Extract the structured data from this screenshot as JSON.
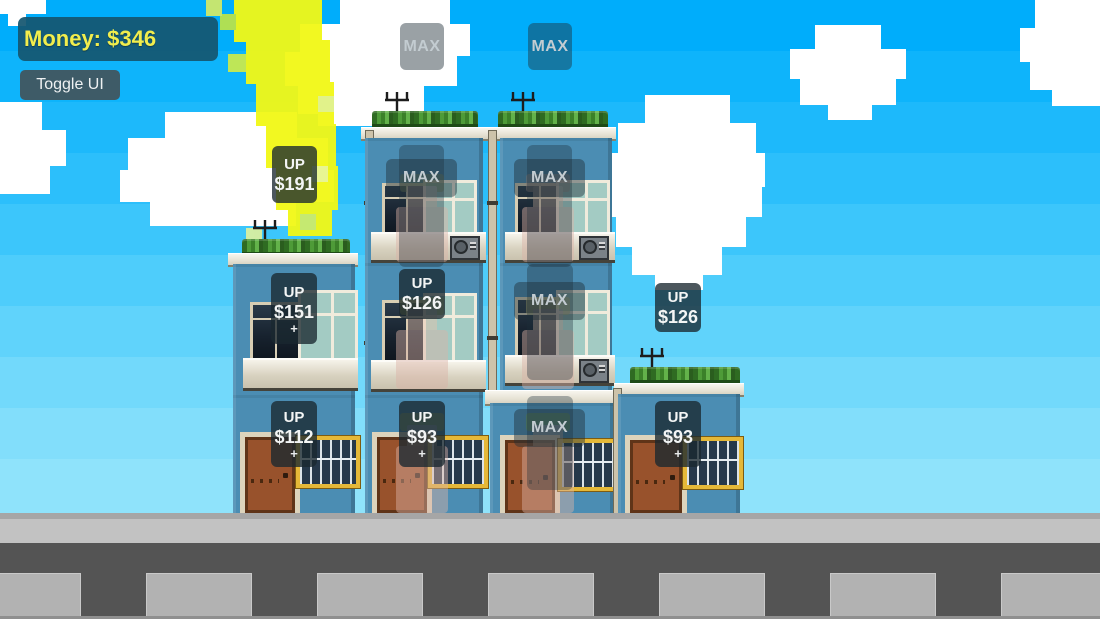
{
  "hud": {
    "money_label": "Money: $346",
    "toggle_button_label": "Toggle UI"
  },
  "overlays": {
    "max_slot_left": {
      "label": "MAX"
    },
    "max_slot_right": {
      "label": "MAX"
    },
    "up_new_floor_left": {
      "action": "UP",
      "price": "$191"
    },
    "up_new_floor_right": {
      "action": "UP",
      "price": "$126"
    },
    "up_col1_floor2": {
      "action": "UP",
      "price": "$151",
      "plus": "+"
    },
    "up_col2_floor2": {
      "action": "UP",
      "price": "$126"
    },
    "up_col1_ground": {
      "action": "UP",
      "price": "$112",
      "plus": "+"
    },
    "up_col2_ground": {
      "action": "UP",
      "price": "$93",
      "plus": "+"
    },
    "up_col4_ground": {
      "action": "UP",
      "price": "$93",
      "plus": "+"
    },
    "max_col2_floor3": {
      "label": "MAX"
    },
    "max_col3_floor3": {
      "label": "MAX"
    },
    "max_col3_floor2": {
      "label": "MAX"
    },
    "max_col3_ground": {
      "label": "MAX"
    }
  },
  "colors": {
    "sky_top": "#00adfb",
    "sky_bottom": "#8fe3fb",
    "money_text": "#f1ed4d",
    "money_panel": "#145670",
    "facade_blue": "#4b8db3",
    "roof_trim": "#edeae0",
    "bush_green": "#4e9b38",
    "door_brown": "#98522c",
    "window_frame_yellow": "#e5b838",
    "road_dark": "#545454",
    "crosswalk_gray": "#b2b2b2",
    "sun_yellow": "#f2f816"
  }
}
